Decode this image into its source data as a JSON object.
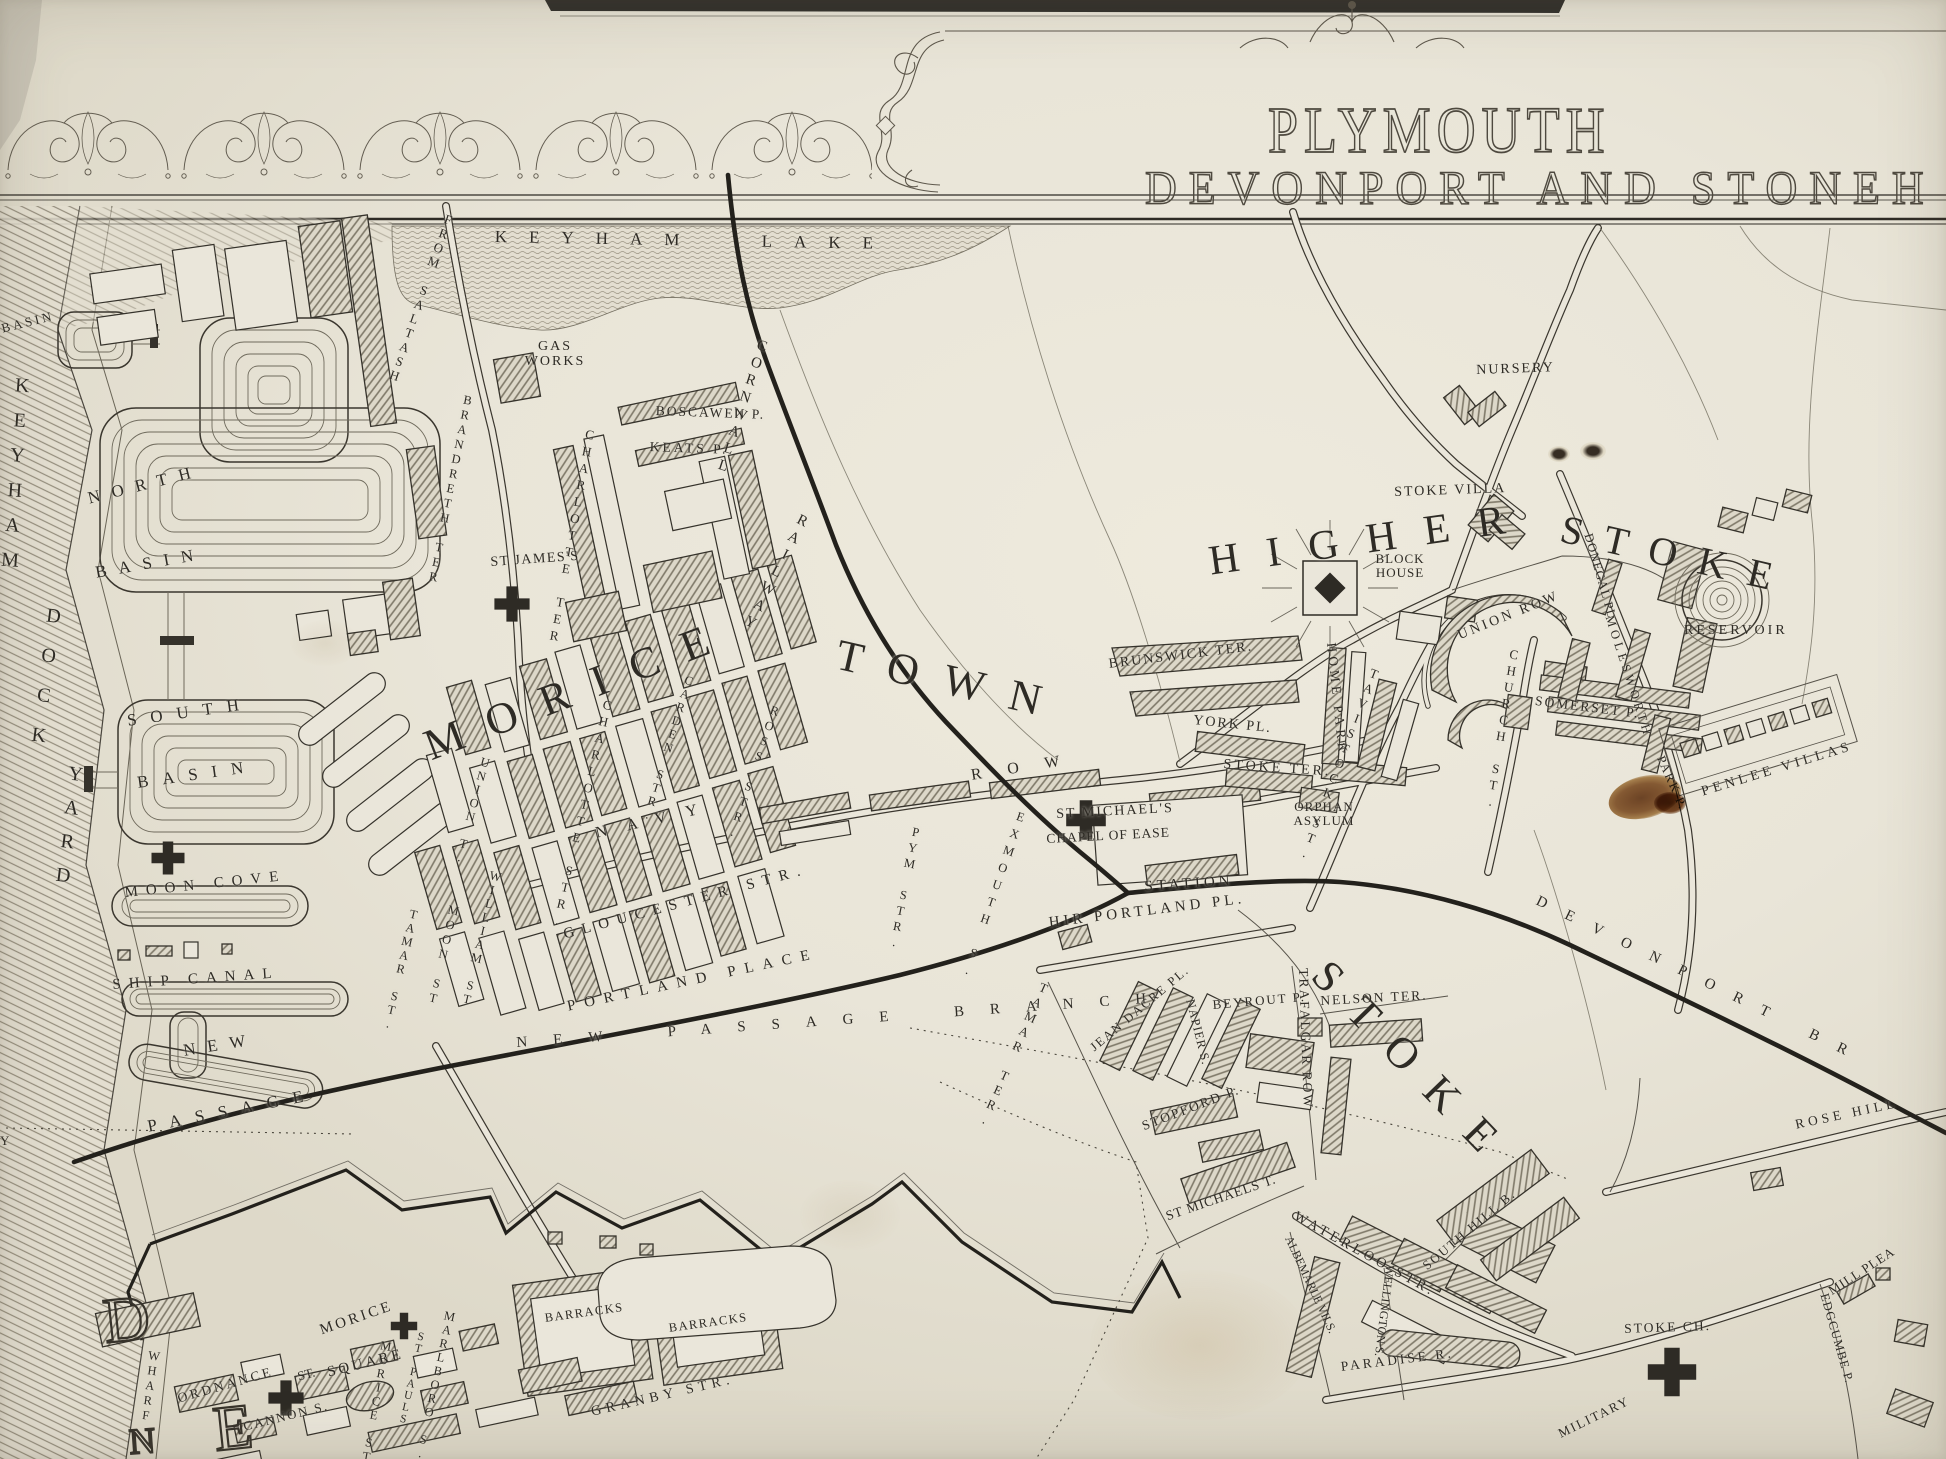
{
  "title": {
    "main": "PLYMOUTH",
    "subtitle": "DEVONPORT AND STONEH"
  },
  "labels": {
    "water": {
      "basin_edge": "BASIN",
      "keyham": "KEYHAM",
      "dock": "DOCK",
      "yard": "YARD",
      "north": "NORTH",
      "north_basin": "BASIN",
      "south": "SOUTH",
      "south_basin": "BASIN",
      "moon_cove": "MOON COVE",
      "ship_canal": "SHIP CANAL",
      "new_word": "NEW",
      "passage": "PASSAGE",
      "keyham_lake": "KEYHAM LAKE",
      "wharf": "WHARF",
      "y_fragment": "Y"
    },
    "rail": {
      "cornwall": "CORNWALL",
      "railway": "RAILWAY",
      "new_passage_branch": "NEW PASSAGE BRANCH",
      "devonport_branch": "DEVONPORT BR",
      "station": "STATION"
    },
    "roads": {
      "from_saltash": "FROM SALTASH",
      "brandreth_ter": "BRANDRETH TER"
    },
    "morice_town": {
      "name_1": "MORICE",
      "name_2": "TOWN",
      "gas_works": "GAS WORKS",
      "st_james": "ST JAMES'S",
      "boscawen": "BOSCAWEN P.",
      "keats": "KEATS P.",
      "charlotte_ter": "CHARLOTTE TER",
      "charlotte_str": "CHARLOTTE STR.",
      "union_t": "UNION T.",
      "william_st": "WILLIAM ST",
      "moon_st": "MOON ST",
      "tamar_st": "TAMAR ST.",
      "navy": "NAVY",
      "row": "ROW",
      "carden_str": "CARDEN STR.",
      "ross_str": "ROSS STR.",
      "gloucester_str": "GLOUCESTER STR.",
      "portland_place": "PORTLAND PLACE",
      "pym_str": "PYM STR.",
      "exmouth_s": "EXMOUTH S."
    },
    "stoke": {
      "higher": "HIGHER",
      "stoke_upper": "STOKE",
      "stoke_lower": "STOKE",
      "block_house": "BLOCK HOUSE",
      "stoke_villa": "STOKE VILLA",
      "nursery": "NURSERY",
      "union_row": "UNION ROW",
      "reservoir": "RESERVOIR",
      "brunswick_ter": "BRUNSWICK TER.",
      "york_pl": "YORK PL.",
      "stoke_ter": "STOKE TER.",
      "home_park": "HOME PARK",
      "tavistock_st": "TAVISTOCK ST.",
      "orphan_asylum": "ORPHAN ASYLUM",
      "church_st": "CHURCH ST.",
      "somerset_p": "SOMERSET P.",
      "donegal_pl": "DONEGAL PL.",
      "molesworth": "MOLESWORTH",
      "park_p": "PARK P.",
      "penlee_villas": "PENLEE VILLAS",
      "st_michaels": "ST MICHAEL'S",
      "chapel_of_ease": "CHAPEL OF EASE",
      "hir_portland_pl": "HIR PORTLAND PL.",
      "nelson_ter": "NELSON TER.",
      "trafalgar_row": "TRAFALGAR ROW",
      "tamar_ter": "TAMAR TER.",
      "jean_dacre_pl": "JEAN DACRE PL.",
      "napier_s": "NAPIER S.",
      "beyrout_p": "BEYROUT P.",
      "stopford_p": "STOPFORD P.",
      "st_michaels_t": "ST MICHAELS T.",
      "waterloo_str": "WATERLOO STR.",
      "south_hill_b": "SOUTH HILL B.",
      "wellington_s": "WELLINGTON S.",
      "albemarle_vils": "ALBEMARLE VILS.",
      "paradise_r": "PARADISE R.",
      "stoke_ch": "STOKE CH.",
      "rose_hill": "ROSE HILL",
      "mill_pleasant": "MILL PLEA",
      "edgcumbe_p": "EDGCUMBE P.",
      "military": "MILITARY"
    },
    "devonport": {
      "barracks_1": "BARRACKS",
      "barracks_2": "BARRACKS",
      "marlboro_s": "MARLBORO S.",
      "st_pauls": "ST PAULS",
      "morice_st": "MORICE ST.",
      "morice_square_1": "MORICE",
      "morice_square_2": "SQUARE",
      "st_abbr": "ST.",
      "ordnance": "ORDNANCE",
      "cannon_s": "CANNON S.",
      "granby_str": "GRANBY STR.",
      "giant_d": "D",
      "giant_e": "E",
      "giant_n": "N"
    }
  },
  "icons": {
    "church_cross": "greek-cross",
    "block_house_fort": "square-with-sunburst",
    "reservoir": "concentric-circles",
    "caisson": "dock-gate-bar"
  }
}
